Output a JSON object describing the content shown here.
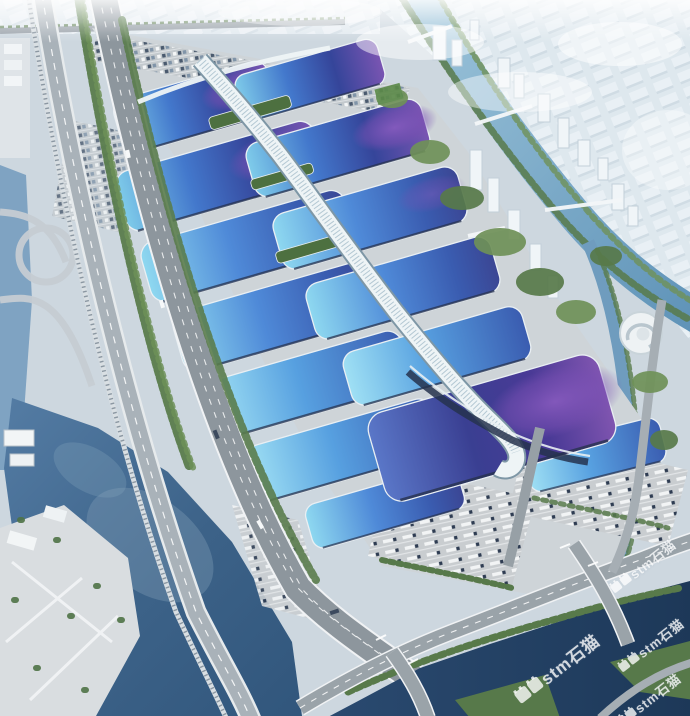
{
  "image": {
    "kind": "aerial-architectural-rendering",
    "subject": "Bird's-eye rendering of a giant exhibition and convention center: paired rows of barrel-vaulted halls with cyan-blue to indigo-purple gradient roofs, a white serpentine central concourse canopy ending in a hook, flanked by a tree-lined expressway corridor, canals and rivers, parking lots, truck marshalling yards and a hazy white city skyline"
  },
  "watermark": {
    "text": "stm石猫",
    "color": "rgba(255,255,255,0.78)",
    "rotation_deg": -38,
    "instances": [
      {
        "x": 643,
        "y": 566,
        "size": 13
      },
      {
        "x": 651,
        "y": 645,
        "size": 13
      },
      {
        "x": 557,
        "y": 668,
        "size": 17
      },
      {
        "x": 648,
        "y": 700,
        "size": 13
      }
    ]
  },
  "palette": {
    "ground": "#cdd7df",
    "plaza": "#ced4d8",
    "roof-cyan": "#86d2ec",
    "roof-blue": "#3f6fc8",
    "roof-indigo": "#35459a",
    "roof-purple": "#7a55b2",
    "spine-white": "#eef4f6",
    "water-river": "#5f93b8",
    "water-lake": "#35597e",
    "water-dark": "#22405f",
    "road-grey": "#8d969d",
    "tree-green": "#5a7c4c",
    "yard-grey": "#c9cdd0",
    "city-haze": "#dde7ee"
  }
}
